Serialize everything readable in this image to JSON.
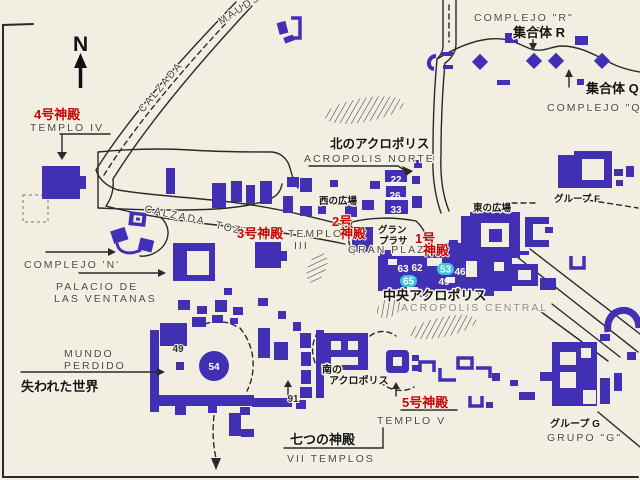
{
  "colors": {
    "bg": "#f2efe2",
    "structure": "#4230b4",
    "red": "#c40404",
    "black": "#151515",
    "gray": "#4a4a4a",
    "graylight": "#8c8c8c",
    "cyan": "#3cc8dc",
    "line": "#2a2a2a"
  },
  "compass": "N",
  "roads": {
    "maudslay_calzada": "CALZADA",
    "maudslay_name": "MAUDSLAY",
    "tozzer_calzada": "CALZADA",
    "tozzer_name": "TOZZER"
  },
  "complexes": {
    "r": {
      "jp": "集合体 R",
      "es": "COMPLEJO \"R\""
    },
    "q": {
      "jp": "集合体 Q",
      "es": "COMPLEJO \"Q\""
    },
    "n": {
      "es": "COMPLEJO 'N'"
    },
    "f": {
      "jp": "グループ F"
    },
    "g": {
      "jp": "グループ G",
      "es": "GRUPO \"G\""
    }
  },
  "temples": {
    "t1": {
      "jp1": "1号",
      "jp2": "神殿"
    },
    "t2": {
      "jp1": "2号",
      "jp2": "神殿"
    },
    "t3": {
      "jp": "3号神殿",
      "es1": "TEMPLO",
      "es2": "III"
    },
    "t4": {
      "jp": "4号神殿",
      "es": "TEMPLO IV"
    },
    "t5": {
      "jp": "5号神殿",
      "es": "TEMPLO V"
    },
    "seven": {
      "jp": "七つの神殿",
      "es": "VII TEMPLOS"
    }
  },
  "acropolis": {
    "north": {
      "jp": "北のアクロポリス",
      "es": "ACROPOLIS NORTE"
    },
    "central": {
      "jp": "中央アクロポリス",
      "es": "ACROPOLIS CENTRAL"
    },
    "south": {
      "jp1": "南の",
      "jp2": "アクロポリス"
    }
  },
  "plazas": {
    "gran": {
      "jp1": "グラン",
      "jp2": "プラサ",
      "es": "GRAN PLAZA"
    },
    "west": {
      "jp": "西の広場"
    },
    "east": {
      "jp": "東の広場"
    }
  },
  "places": {
    "mundo": {
      "es1": "MUNDO",
      "es2": "PERDIDO",
      "jp": "失われた世界"
    },
    "palacio": {
      "es1": "PALACIO DE",
      "es2": "LAS VENTANAS"
    }
  },
  "numbers": {
    "n22": "22",
    "n26": "26",
    "n33": "33",
    "n63": "63",
    "n62": "62",
    "n53": "53",
    "n46": "46",
    "n65": "65",
    "n49": "49",
    "mp49": "49",
    "mp54": "54",
    "mp91": "91"
  }
}
